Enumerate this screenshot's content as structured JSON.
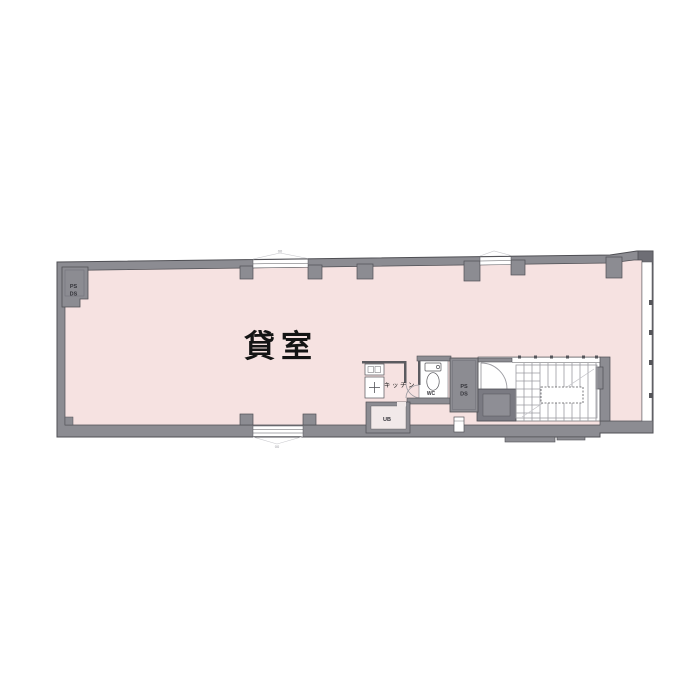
{
  "plan": {
    "room_label": "貸室",
    "kitchen_label": "キッチン",
    "wc_label": "WC",
    "ub_label": "UB",
    "ps_label": "PS",
    "ds_label": "DS",
    "window_tag": "00",
    "colors": {
      "floor_pink": "#f6e2e1",
      "wall_gray": "#8c8c92",
      "wall_outline": "#4f4f54",
      "shaft_dark": "#7a7a82",
      "shaft_inner": "#8e8e95",
      "stair_line": "#9b9ba1",
      "white": "#ffffff"
    }
  }
}
